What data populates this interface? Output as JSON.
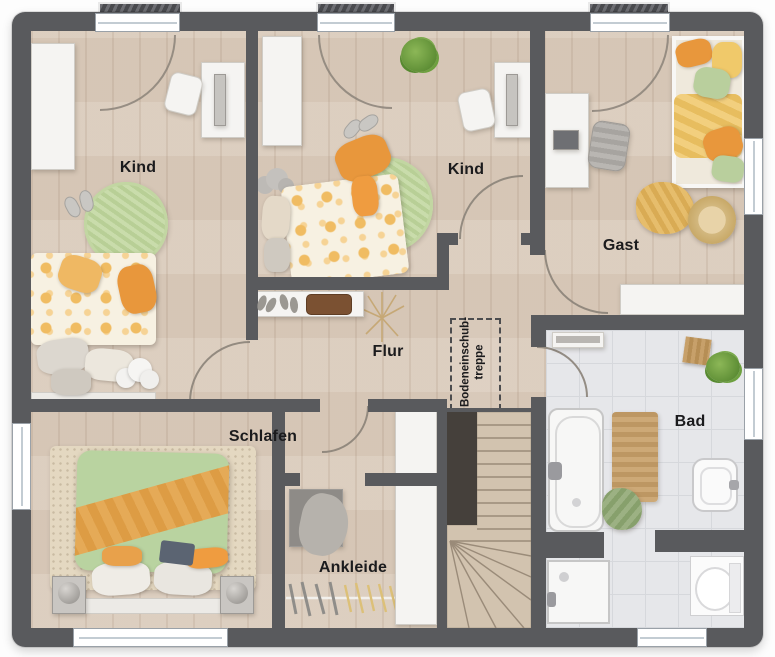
{
  "plan_type": "floor-plan-upper-storey",
  "rooms": {
    "kind1": {
      "label": "Kind"
    },
    "kind2": {
      "label": "Kind"
    },
    "gast": {
      "label": "Gast"
    },
    "flur": {
      "label": "Flur"
    },
    "schlafen": {
      "label": "Schlafen"
    },
    "ankleide": {
      "label": "Ankleide"
    },
    "bad": {
      "label": "Bad"
    }
  },
  "annotations": {
    "attic_stairs": {
      "line1": "Bodeneinschub-",
      "line2": "treppe"
    }
  },
  "colors": {
    "wall": "#595a5d",
    "wood_floor": "#dacbbb",
    "tile_floor": "#e6e7ea",
    "stair_wood": "#d2c3af",
    "stair_void": "#45403b",
    "accent_orange": "#e8973c",
    "textile_green": "#b9d3a0",
    "rug_green": "#c2d6a2",
    "furniture_white": "#f5f4f2",
    "label_text": "#1b1b1d"
  }
}
